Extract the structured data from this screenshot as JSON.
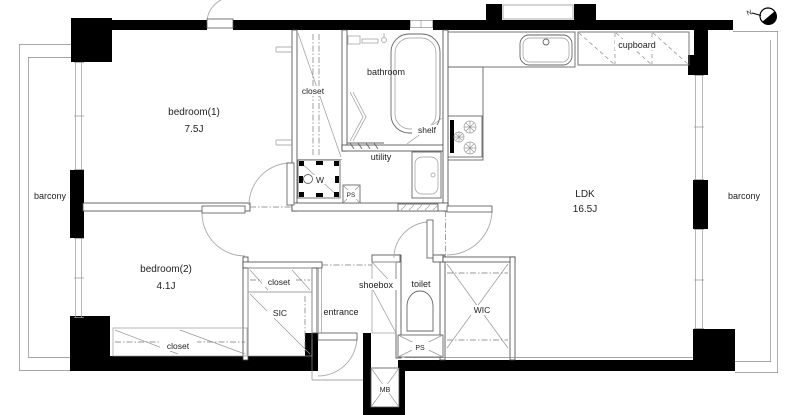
{
  "labels": {
    "bedroom1_name": "bedroom(1)",
    "bedroom1_size": "7.5J",
    "bedroom2_name": "bedroom(2)",
    "bedroom2_size": "4.1J",
    "ldk_name": "LDK",
    "ldk_size": "16.5J",
    "bathroom": "bathroom",
    "utility": "utility",
    "shelf": "shelf",
    "closet_top": "closet",
    "closet_mid": "closet",
    "closet_bottom": "closet",
    "cupboard": "cupboard",
    "barcony_left": "barcony",
    "barcony_right": "barcony",
    "entrance": "entrance",
    "shoebox": "shoebox",
    "toilet": "toilet",
    "wic": "WIC",
    "sic": "SIC",
    "ps_utility": "PS",
    "ps_toilet": "PS",
    "mb": "MB",
    "washer": "W",
    "compass_north": "N"
  }
}
